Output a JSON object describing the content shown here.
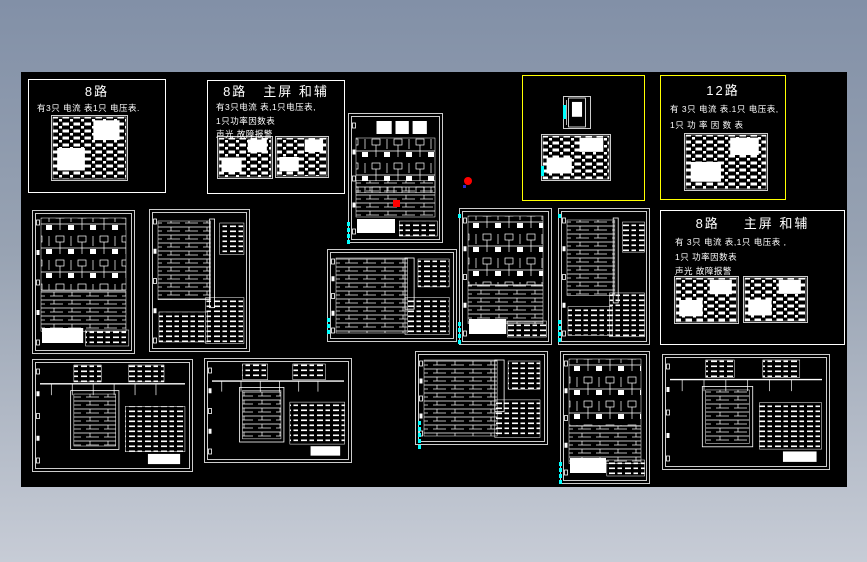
{
  "window": {
    "canvas_background": "#000000",
    "frame_gradient_top": "#8290a7",
    "frame_gradient_bottom": "#c7ccd6"
  },
  "colors": {
    "line": "#ffffff",
    "highlight_yellow": "#ffff00",
    "mark_cyan": "#00ffff",
    "marker_red": "#ff0000",
    "marker_blue": "#2a2ad0"
  },
  "panels": {
    "eight_a": {
      "title": "8路",
      "lines": [
        "有3只 电流 表1只 电压表."
      ]
    },
    "eight_main_aux_top": {
      "title": "8路",
      "subtitle": "主屏 和辅",
      "lines": [
        "有3只电流 表,1只电压表,",
        "1只功率因数表",
        "声光 故障报警"
      ]
    },
    "twelve": {
      "title": "12路",
      "lines": [
        "有 3只 电流 表.1只 电压表,",
        "1只 功 率 因 数 表"
      ]
    },
    "eight_main_aux_right": {
      "title": "8路",
      "subtitle": "主屏 和辅",
      "lines": [
        "有 3只 电流 表,1只 电压表 ,",
        "1只 功率因数表",
        "声光 故障报警"
      ]
    }
  }
}
